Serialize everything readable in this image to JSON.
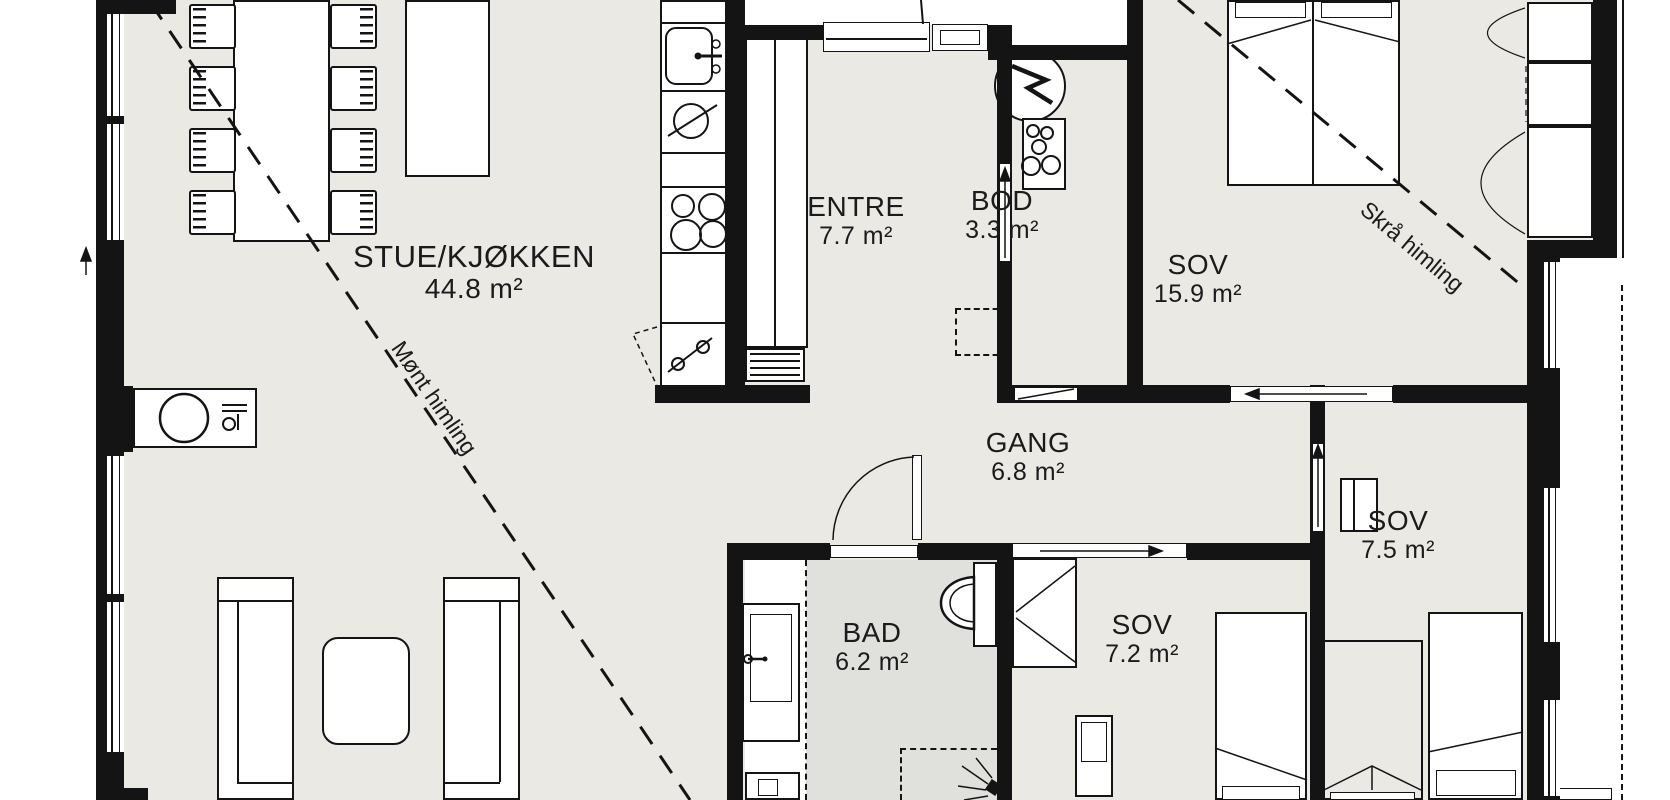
{
  "title": "Floor plan",
  "rooms": [
    {
      "name": "STUE/KJØKKEN",
      "area": "44.8 m²"
    },
    {
      "name": "ENTRE",
      "area": "7.7 m²"
    },
    {
      "name": "BOD",
      "area": "3.3 m²"
    },
    {
      "name": "SOV",
      "area": "15.9 m²"
    },
    {
      "name": "GANG",
      "area": "6.8 m²"
    },
    {
      "name": "SOV",
      "area": "7.5 m²"
    },
    {
      "name": "SOV",
      "area": "7.2 m²"
    },
    {
      "name": "BAD",
      "area": "6.2 m²"
    }
  ],
  "ceiling_annotations": [
    {
      "label": "Mønt himling"
    },
    {
      "label": "Skrå himling"
    }
  ],
  "icons": [
    "water-heater-lightning-icon",
    "shower-head-icon",
    "fireplace-chimney-icon",
    "cooktop-burners-icon",
    "sink-icon",
    "toilet-icon",
    "sliding-door-arrow-icon",
    "door-swing-arc-icon"
  ],
  "colors": {
    "floor": "#eae9e4",
    "bathroom_floor": "#e0e0dd",
    "walls": "#141414",
    "furniture_fill": "#ffffff",
    "outside": "#ffffff"
  }
}
